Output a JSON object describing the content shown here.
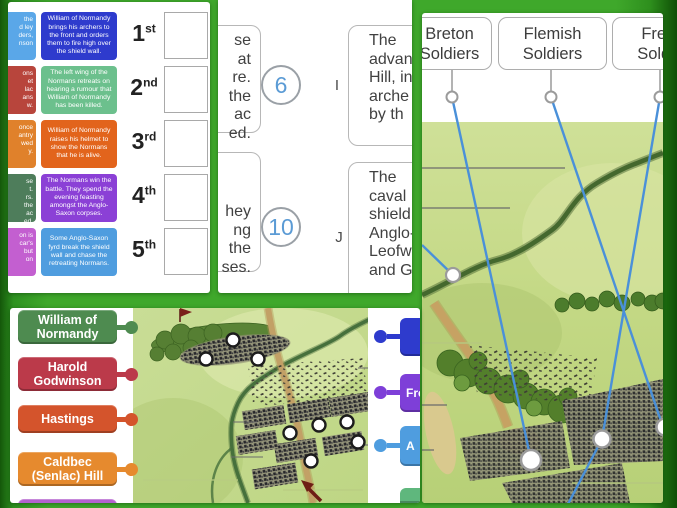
{
  "background": {
    "green": "#3fa82b",
    "edge_dark_green": "#14570a"
  },
  "panelA": {
    "cut_cards": [
      {
        "color": "#5aa7e8",
        "text": "the\nd ley\nders,\nnson"
      },
      {
        "color": "#b8453c",
        "text": "ons\net\nlac\nans\nw."
      },
      {
        "color": "#e0812b",
        "text": "once\nantry\nwed\ny."
      },
      {
        "color": "#4e7d5b",
        "text": "se\nt.\nrs.\nthe\nac\ned."
      },
      {
        "color": "#c35fd0",
        "text": "on is\ncar's\nbut\non"
      }
    ],
    "cards": [
      {
        "color": "#2e3bcd",
        "text": "William of Normandy brings his archers to the front and orders them to fire high over the shield wall."
      },
      {
        "color": "#6cc08d",
        "text": "The left wing of the Normans retreats on hearing a rumour that William of Normandy has been killed."
      },
      {
        "color": "#e2641c",
        "text": "William of Normandy raises his helmet to show the Normans that he is alive."
      },
      {
        "color": "#8b40d6",
        "text": "The Normans win the battle. They spend the evening feasting amongst the Anglo-Saxon corpses."
      },
      {
        "color": "#4f9ddf",
        "text": "Some Anglo-Saxon fyrd break the shield wall and chase the retreating Normans."
      }
    ],
    "ordinals": [
      {
        "num": "1",
        "suf": "st"
      },
      {
        "num": "2",
        "suf": "nd"
      },
      {
        "num": "3",
        "suf": "rd"
      },
      {
        "num": "4",
        "suf": "th"
      },
      {
        "num": "5",
        "suf": "th"
      }
    ]
  },
  "panelB": {
    "number_color": "#5b9bd5",
    "rows": [
      {
        "left_text": "se\nat\nre.\nthe\nac\ned.",
        "number": "6",
        "letter": "I",
        "right_text": "The\nadvanc\nHill, in\narche\nby th"
      },
      {
        "left_text": "hey\nng\nthe\nses.",
        "number": "10",
        "letter": "J",
        "right_text": "The\ncaval\nshield w\nAnglo-S\nLeofwi\nand Gyr"
      }
    ]
  },
  "panelC": {
    "line_color": "#4a90d9",
    "labels": [
      {
        "text": "Breton Soldiers"
      },
      {
        "text": "Flemish Soldiers"
      },
      {
        "text": "French Soldiers"
      }
    ]
  },
  "panelD": {
    "labels": [
      {
        "color": "#4e8b50",
        "text": "William of\nNormandy"
      },
      {
        "color": "#bb3a4a",
        "text": "Harold\nGodwinson"
      },
      {
        "color": "#d4542c",
        "text": "Hastings"
      },
      {
        "color": "#e68a2e",
        "text": "Caldbec\n(Senlac) Hill"
      },
      {
        "color": "#b361ce",
        "text": ""
      }
    ],
    "right_labels": [
      {
        "color": "#2e3bcd",
        "text": ""
      },
      {
        "color": "#7e3fd8",
        "text": "Fre"
      },
      {
        "color": "#4f9ddf",
        "text": "A"
      },
      {
        "color": "#5fb77d",
        "text": ""
      }
    ]
  }
}
